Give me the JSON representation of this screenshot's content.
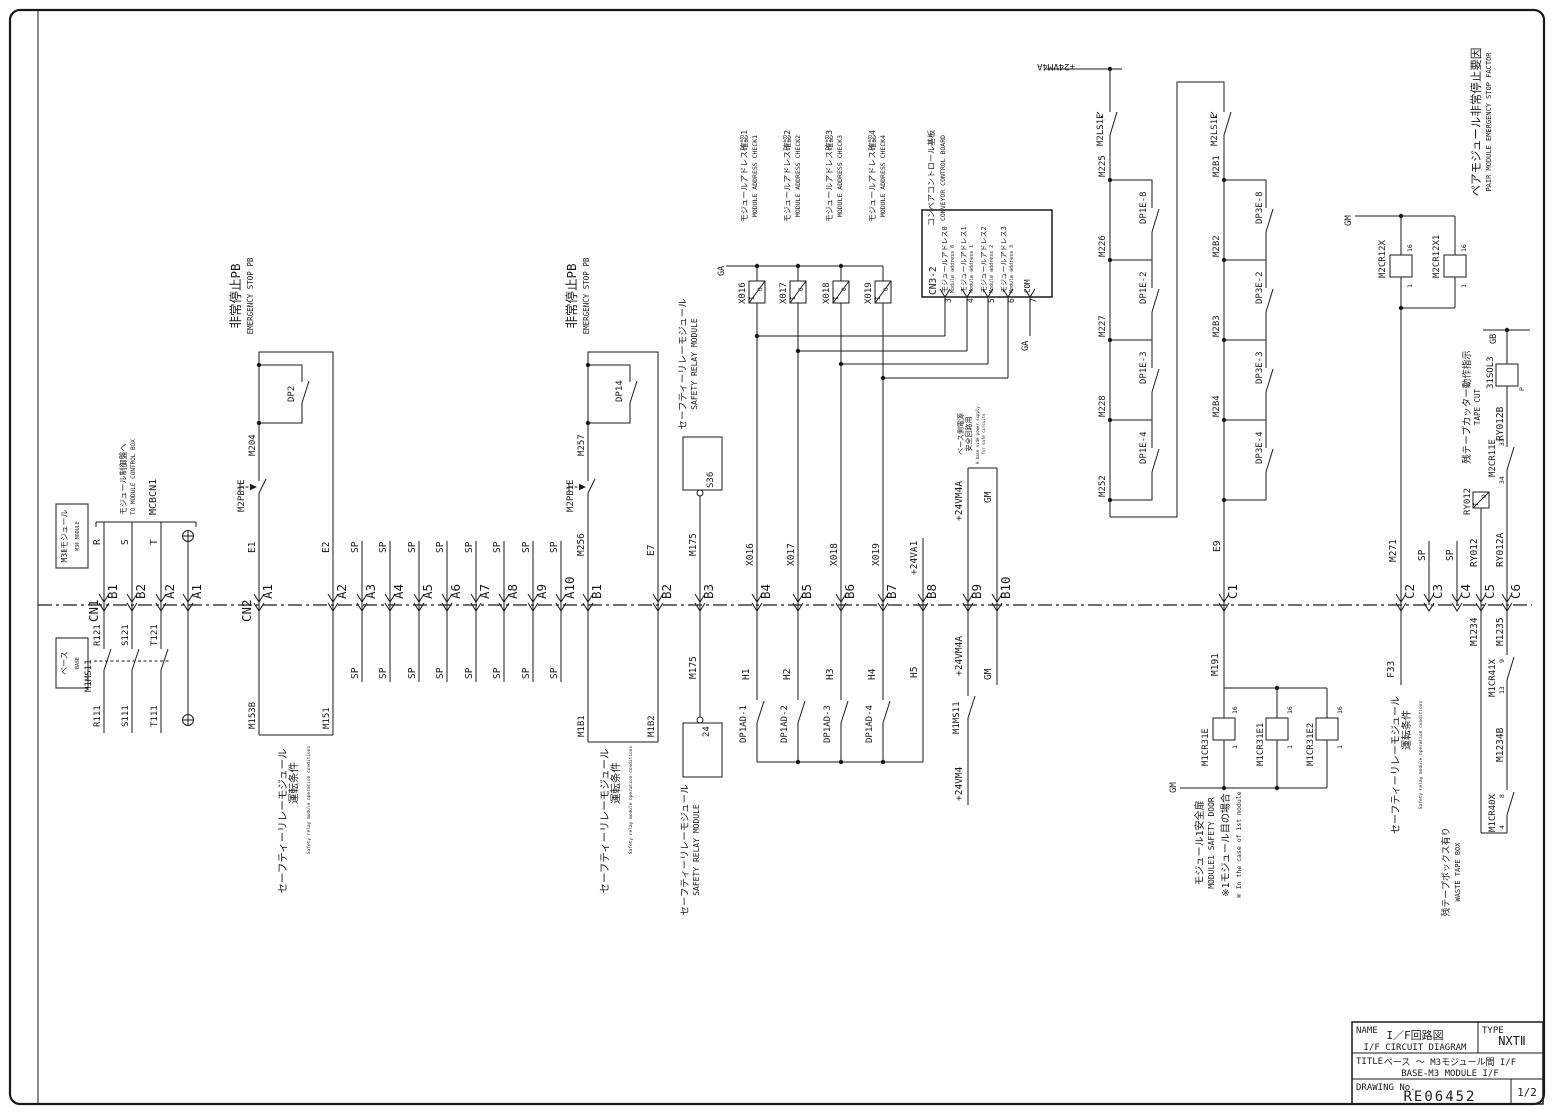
{
  "title_block": {
    "name_label": "NAME",
    "name_jp": "I／F回路図",
    "name_en": "I/F CIRCUIT DIAGRAM",
    "type_label": "TYPE",
    "type_value": "NXTⅡ",
    "title_label": "TITLE",
    "title_jp": "ベース 〜 M3モジュール間 I/F",
    "title_en": "BASE-M3 MODULE I/F",
    "drawing_no_label": "DRAWING No.",
    "drawing_no": "RE06452",
    "page": "1/2"
  },
  "pins": [
    {
      "id": "B1",
      "x": 104
    },
    {
      "id": "B2",
      "x": 132
    },
    {
      "id": "A2",
      "x": 161
    },
    {
      "id": "A1",
      "x": 188
    },
    {
      "id": "A1",
      "x": 259
    },
    {
      "id": "A2",
      "x": 333
    },
    {
      "id": "A3",
      "x": 362
    },
    {
      "id": "A4",
      "x": 390
    },
    {
      "id": "A5",
      "x": 419
    },
    {
      "id": "A6",
      "x": 447
    },
    {
      "id": "A7",
      "x": 476
    },
    {
      "id": "A8",
      "x": 504
    },
    {
      "id": "A9",
      "x": 533
    },
    {
      "id": "A10",
      "x": 561
    },
    {
      "id": "B1",
      "x": 588
    },
    {
      "id": "B2",
      "x": 658
    },
    {
      "id": "B3",
      "x": 700
    },
    {
      "id": "B4",
      "x": 757
    },
    {
      "id": "B5",
      "x": 798
    },
    {
      "id": "B6",
      "x": 841
    },
    {
      "id": "B7",
      "x": 883
    },
    {
      "id": "B8",
      "x": 923
    },
    {
      "id": "B9",
      "x": 968
    },
    {
      "id": "B10",
      "x": 997
    },
    {
      "id": "C1",
      "x": 1224
    },
    {
      "id": "C2",
      "x": 1401
    },
    {
      "id": "C3",
      "x": 1429
    },
    {
      "id": "C4",
      "x": 1457
    },
    {
      "id": "C5",
      "x": 1481
    },
    {
      "id": "C6",
      "x": 1507
    }
  ],
  "labels": [
    {
      "t": "M3Ⅱモジュール",
      "x": 67,
      "y": 536,
      "s": 8,
      "a": "m"
    },
    {
      "t": "M3Ⅱ MODULE",
      "x": 79,
      "y": 536,
      "s": 5,
      "a": "m"
    },
    {
      "t": "ベース",
      "x": 67,
      "y": 663,
      "s": 8,
      "a": "m"
    },
    {
      "t": "BASE",
      "x": 79,
      "y": 663,
      "s": 5,
      "a": "m"
    },
    {
      "t": "CN1",
      "x": 98,
      "y": 622,
      "s": 12.5
    },
    {
      "t": "モジュール制御盤へ",
      "x": 126,
      "y": 515,
      "s": 8
    },
    {
      "t": "TO MODULE CONTROL BOX",
      "x": 135,
      "y": 515,
      "s": 6
    },
    {
      "t": "MCBCN1",
      "x": 156,
      "y": 515,
      "s": 10
    },
    {
      "t": "R",
      "x": 100,
      "y": 545
    },
    {
      "t": "S",
      "x": 128,
      "y": 545
    },
    {
      "t": "T",
      "x": 157,
      "y": 545
    },
    {
      "t": "R121",
      "x": 100,
      "y": 646,
      "s": 9
    },
    {
      "t": "S121",
      "x": 128,
      "y": 646,
      "s": 9
    },
    {
      "t": "T121",
      "x": 157,
      "y": 646,
      "s": 9
    },
    {
      "t": "M1MS11",
      "x": 91,
      "y": 692,
      "s": 9
    },
    {
      "t": "R111",
      "x": 100,
      "y": 727,
      "s": 9
    },
    {
      "t": "S111",
      "x": 128,
      "y": 727,
      "s": 9
    },
    {
      "t": "T111",
      "x": 157,
      "y": 727,
      "s": 9
    },
    {
      "t": "CN2",
      "x": 251,
      "y": 622,
      "s": 12.5
    },
    {
      "t": "E1",
      "x": 255,
      "y": 553
    },
    {
      "t": "M2PB1E",
      "x": 244,
      "y": 512,
      "s": 9
    },
    {
      "t": "M204",
      "x": 255,
      "y": 456,
      "s": 9
    },
    {
      "t": "DP2",
      "x": 294,
      "y": 402,
      "s": 9
    },
    {
      "t": "E2",
      "x": 329,
      "y": 553
    },
    {
      "t": "非常停止PB",
      "x": 240,
      "y": 296,
      "a": "m",
      "s": 12.5
    },
    {
      "t": "EMERGENCY STOP PB",
      "x": 253,
      "y": 296,
      "a": "m",
      "s": 7.5
    },
    {
      "t": "M153B",
      "x": 255,
      "y": 729,
      "s": 9
    },
    {
      "t": "M151",
      "x": 329,
      "y": 729,
      "s": 9
    },
    {
      "t": "セーフティーリレーモジュール",
      "x": 286,
      "y": 821,
      "a": "m",
      "s": 10.5
    },
    {
      "t": "運転条件",
      "x": 297,
      "y": 783,
      "a": "m",
      "s": 10.5
    },
    {
      "t": "Safety relay module operation conditions",
      "x": 310,
      "y": 800,
      "a": "m",
      "s": 4.5
    },
    {
      "t": "SP",
      "x": 358,
      "y": 553
    },
    {
      "t": "SP",
      "x": 386,
      "y": 553
    },
    {
      "t": "SP",
      "x": 415,
      "y": 553
    },
    {
      "t": "SP",
      "x": 443,
      "y": 553
    },
    {
      "t": "SP",
      "x": 472,
      "y": 553
    },
    {
      "t": "SP",
      "x": 500,
      "y": 553
    },
    {
      "t": "SP",
      "x": 529,
      "y": 553
    },
    {
      "t": "SP",
      "x": 557,
      "y": 553
    },
    {
      "t": "SP",
      "x": 358,
      "y": 679
    },
    {
      "t": "SP",
      "x": 386,
      "y": 679
    },
    {
      "t": "SP",
      "x": 415,
      "y": 679
    },
    {
      "t": "SP",
      "x": 443,
      "y": 679
    },
    {
      "t": "SP",
      "x": 472,
      "y": 679
    },
    {
      "t": "SP",
      "x": 500,
      "y": 679
    },
    {
      "t": "SP",
      "x": 529,
      "y": 679
    },
    {
      "t": "SP",
      "x": 557,
      "y": 679
    },
    {
      "t": "M256",
      "x": 584,
      "y": 556
    },
    {
      "t": "M2PB1E",
      "x": 573,
      "y": 512,
      "s": 9
    },
    {
      "t": "M257",
      "x": 584,
      "y": 456,
      "s": 9
    },
    {
      "t": "DP14",
      "x": 622,
      "y": 402,
      "s": 9
    },
    {
      "t": "E7",
      "x": 654,
      "y": 556
    },
    {
      "t": "非常停止PB",
      "x": 576,
      "y": 296,
      "a": "m",
      "s": 12.5
    },
    {
      "t": "EMERGENCY STOP PB",
      "x": 589,
      "y": 296,
      "a": "m",
      "s": 7.5
    },
    {
      "t": "M1B1",
      "x": 584,
      "y": 737,
      "s": 9
    },
    {
      "t": "M1B2",
      "x": 654,
      "y": 737,
      "s": 9
    },
    {
      "t": "セーフティーリレーモジュール",
      "x": 608,
      "y": 821,
      "a": "m",
      "s": 10.5
    },
    {
      "t": "運転条件",
      "x": 619,
      "y": 783,
      "a": "m",
      "s": 10.5
    },
    {
      "t": "Safety relay module operation conditions",
      "x": 632,
      "y": 800,
      "a": "m",
      "s": 4.5
    },
    {
      "t": "M175",
      "x": 696,
      "y": 556
    },
    {
      "t": "S36",
      "x": 713,
      "y": 488,
      "s": 9
    },
    {
      "t": "セーフティーリレーモジュール",
      "x": 686,
      "y": 364,
      "a": "m",
      "s": 9.5
    },
    {
      "t": "SAFETY RELAY MODULE",
      "x": 697,
      "y": 364,
      "a": "m",
      "s": 8
    },
    {
      "t": "M175",
      "x": 696,
      "y": 679
    },
    {
      "t": "24",
      "x": 709,
      "y": 737,
      "s": 9
    },
    {
      "t": "セーフティーリレーモジュール",
      "x": 688,
      "y": 850,
      "a": "m",
      "s": 9.5
    },
    {
      "t": "SAFETY RELAY MODULE",
      "x": 699,
      "y": 850,
      "a": "m",
      "s": 8
    },
    {
      "t": "X016",
      "x": 753,
      "y": 566
    },
    {
      "t": "X017",
      "x": 794,
      "y": 566
    },
    {
      "t": "X018",
      "x": 837,
      "y": 566
    },
    {
      "t": "X019",
      "x": 879,
      "y": 566
    },
    {
      "t": "X016",
      "x": 745,
      "y": 304,
      "s": 9
    },
    {
      "t": "X017",
      "x": 786,
      "y": 304,
      "s": 9
    },
    {
      "t": "X018",
      "x": 829,
      "y": 304,
      "s": 9
    },
    {
      "t": "X019",
      "x": 871,
      "y": 304,
      "s": 9
    },
    {
      "t": "モジュールアドレス確認1",
      "x": 747,
      "y": 176,
      "a": "m",
      "s": 8
    },
    {
      "t": "モジュールアドレス確認2",
      "x": 790,
      "y": 176,
      "a": "m",
      "s": 8
    },
    {
      "t": "モジュールアドレス確認3",
      "x": 832,
      "y": 176,
      "a": "m",
      "s": 8
    },
    {
      "t": "モジュールアドレス確認4",
      "x": 875,
      "y": 176,
      "a": "m",
      "s": 8
    },
    {
      "t": "MODULE ADDRESS CHECK1",
      "x": 757,
      "y": 176,
      "a": "m",
      "s": 6.5
    },
    {
      "t": "MODULE ADDRESS CHECK2",
      "x": 800,
      "y": 176,
      "a": "m",
      "s": 6.5
    },
    {
      "t": "MODULE ADDRESS CHECK3",
      "x": 842,
      "y": 176,
      "a": "m",
      "s": 6.5
    },
    {
      "t": "MODULE ADDRESS CHECK4",
      "x": 885,
      "y": 176,
      "a": "m",
      "s": 6.5
    },
    {
      "t": "GA",
      "x": 724,
      "y": 276,
      "s": 8.5
    },
    {
      "t": "コンベアコントロール基板",
      "x": 934,
      "y": 178,
      "a": "m",
      "s": 8
    },
    {
      "t": "CONVEYOR CONTROL BOARD",
      "x": 945,
      "y": 178,
      "a": "m",
      "s": 6.5
    },
    {
      "t": "CN3-2",
      "x": 936,
      "y": 295,
      "s": 9.5
    },
    {
      "t": "モジュールアドレス0",
      "x": 947,
      "y": 293,
      "s": 7
    },
    {
      "t": "Module address 0",
      "x": 954,
      "y": 293,
      "s": 5
    },
    {
      "t": "モジュールアドレス1",
      "x": 966,
      "y": 293,
      "s": 7
    },
    {
      "t": "Module address 1",
      "x": 973,
      "y": 293,
      "s": 5
    },
    {
      "t": "モジュールアドレス2",
      "x": 986,
      "y": 293,
      "s": 7
    },
    {
      "t": "Module address 2",
      "x": 993,
      "y": 293,
      "s": 5
    },
    {
      "t": "モジュールアドレス3",
      "x": 1006,
      "y": 293,
      "s": 7
    },
    {
      "t": "Module address 3",
      "x": 1013,
      "y": 293,
      "s": 5
    },
    {
      "t": "COM",
      "x": 1030,
      "y": 293,
      "s": 7.5
    },
    {
      "t": "3",
      "x": 951,
      "y": 303,
      "s": 8
    },
    {
      "t": "4",
      "x": 973,
      "y": 303,
      "s": 8
    },
    {
      "t": "5",
      "x": 994,
      "y": 303,
      "s": 8
    },
    {
      "t": "6",
      "x": 1014,
      "y": 303,
      "s": 8
    },
    {
      "t": "7",
      "x": 1036,
      "y": 303,
      "s": 8
    },
    {
      "t": "GA",
      "x": 1028,
      "y": 351,
      "s": 8.5
    },
    {
      "t": "H1",
      "x": 749,
      "y": 680
    },
    {
      "t": "H2",
      "x": 790,
      "y": 680
    },
    {
      "t": "H3",
      "x": 833,
      "y": 680
    },
    {
      "t": "H4",
      "x": 875,
      "y": 680
    },
    {
      "t": "H5",
      "x": 917,
      "y": 678
    },
    {
      "t": "DP1AD-1",
      "x": 746,
      "y": 743,
      "s": 9
    },
    {
      "t": "DP1AD-2",
      "x": 787,
      "y": 743,
      "s": 9
    },
    {
      "t": "DP1AD-3",
      "x": 830,
      "y": 743,
      "s": 9
    },
    {
      "t": "DP1AD-4",
      "x": 872,
      "y": 743,
      "s": 9
    },
    {
      "t": "+24VA1",
      "x": 917,
      "y": 575
    },
    {
      "t": "+24VM4A",
      "x": 962,
      "y": 521
    },
    {
      "t": "GM",
      "x": 991,
      "y": 503
    },
    {
      "t": "ベース側電源",
      "x": 963,
      "y": 434,
      "a": "m",
      "s": 7
    },
    {
      "t": "安全回路用",
      "x": 971,
      "y": 434,
      "a": "m",
      "s": 7
    },
    {
      "t": "A base side power supply.",
      "x": 979,
      "y": 434,
      "a": "m",
      "s": 4
    },
    {
      "t": "for safe circuits",
      "x": 985,
      "y": 434,
      "a": "m",
      "s": 4
    },
    {
      "t": "+24VM4A",
      "x": 962,
      "y": 676
    },
    {
      "t": "M1MS11",
      "x": 959,
      "y": 734,
      "s": 9
    },
    {
      "t": "+24VM4",
      "x": 962,
      "y": 801
    },
    {
      "t": "GM",
      "x": 991,
      "y": 680
    },
    {
      "t": "+24VM4A",
      "x": 1056,
      "y": 64,
      "r": 180,
      "a": "m",
      "s": 9
    },
    {
      "t": "M2LS1E",
      "x": 1103,
      "y": 146,
      "s": 9
    },
    {
      "t": "M2LS1E",
      "x": 1217,
      "y": 146,
      "s": 9
    },
    {
      "t": "M225",
      "x": 1105,
      "y": 177,
      "s": 9
    },
    {
      "t": "M226",
      "x": 1105,
      "y": 257,
      "s": 9
    },
    {
      "t": "M227",
      "x": 1105,
      "y": 337,
      "s": 9
    },
    {
      "t": "M228",
      "x": 1105,
      "y": 417,
      "s": 9
    },
    {
      "t": "M252",
      "x": 1105,
      "y": 497,
      "s": 9
    },
    {
      "t": "DP1E-8",
      "x": 1146,
      "y": 224,
      "s": 9
    },
    {
      "t": "DP1E-2",
      "x": 1146,
      "y": 304,
      "s": 9
    },
    {
      "t": "DP1E-3",
      "x": 1146,
      "y": 384,
      "s": 9
    },
    {
      "t": "DP1E-4",
      "x": 1146,
      "y": 464,
      "s": 9
    },
    {
      "t": "M2B1",
      "x": 1219,
      "y": 177,
      "s": 9
    },
    {
      "t": "M2B2",
      "x": 1219,
      "y": 257,
      "s": 9
    },
    {
      "t": "M2B3",
      "x": 1219,
      "y": 337,
      "s": 9
    },
    {
      "t": "M2B4",
      "x": 1219,
      "y": 417,
      "s": 9
    },
    {
      "t": "DP3E-8",
      "x": 1262,
      "y": 224,
      "s": 9
    },
    {
      "t": "DP3E-2",
      "x": 1262,
      "y": 304,
      "s": 9
    },
    {
      "t": "DP3E-3",
      "x": 1262,
      "y": 384,
      "s": 9
    },
    {
      "t": "DP3E-4",
      "x": 1262,
      "y": 464,
      "s": 9
    },
    {
      "t": "E9",
      "x": 1220,
      "y": 552
    },
    {
      "t": "M191",
      "x": 1218,
      "y": 676
    },
    {
      "t": "GM",
      "x": 1176,
      "y": 793,
      "s": 9
    },
    {
      "t": "M1CR31E",
      "x": 1208,
      "y": 766,
      "s": 9
    },
    {
      "t": "M1CR31E1",
      "x": 1263,
      "y": 766,
      "s": 9
    },
    {
      "t": "M1CR31E2",
      "x": 1313,
      "y": 766,
      "s": 9
    },
    {
      "t": "16",
      "x": 1237,
      "y": 714,
      "s": 6.5
    },
    {
      "t": "1",
      "x": 1237,
      "y": 749,
      "s": 6.5
    },
    {
      "t": "16",
      "x": 1292,
      "y": 714,
      "s": 6.5
    },
    {
      "t": "1",
      "x": 1292,
      "y": 749,
      "s": 6.5
    },
    {
      "t": "16",
      "x": 1342,
      "y": 714,
      "s": 6.5
    },
    {
      "t": "1",
      "x": 1342,
      "y": 749,
      "s": 6.5
    },
    {
      "t": "モジュール1安全扉",
      "x": 1203,
      "y": 843,
      "a": "m",
      "s": 10
    },
    {
      "t": "MODULE1 SAFETY DOOR",
      "x": 1214,
      "y": 843,
      "a": "m",
      "s": 8
    },
    {
      "t": "※1モジュール目の場合",
      "x": 1229,
      "y": 845,
      "a": "m",
      "s": 10
    },
    {
      "t": "※ In the case of 1st module",
      "x": 1241,
      "y": 845,
      "a": "m",
      "s": 6.5
    },
    {
      "t": "ペアモジュール非常停止要因",
      "x": 1480,
      "y": 122,
      "a": "m",
      "s": 11.5
    },
    {
      "t": "PAIR MODULE EMERGENCY STOP FACTOR",
      "x": 1491,
      "y": 122,
      "a": "m",
      "s": 7
    },
    {
      "t": "GM",
      "x": 1351,
      "y": 226,
      "s": 9
    },
    {
      "t": "M2CR12X",
      "x": 1385,
      "y": 278,
      "s": 9
    },
    {
      "t": "M2CR12X1",
      "x": 1439,
      "y": 278,
      "s": 9
    },
    {
      "t": "16",
      "x": 1412,
      "y": 252,
      "s": 6.5
    },
    {
      "t": "1",
      "x": 1412,
      "y": 288,
      "s": 6.5
    },
    {
      "t": "16",
      "x": 1466,
      "y": 252,
      "s": 6.5
    },
    {
      "t": "1",
      "x": 1466,
      "y": 288,
      "s": 6.5
    },
    {
      "t": "M271",
      "x": 1396,
      "y": 562
    },
    {
      "t": "F33",
      "x": 1394,
      "y": 678
    },
    {
      "t": "セーフティーリレーモジュール",
      "x": 1399,
      "y": 765,
      "a": "m",
      "s": 10
    },
    {
      "t": "運転条件",
      "x": 1410,
      "y": 730,
      "a": "m",
      "s": 10
    },
    {
      "t": "Safety relay module operation conditions",
      "x": 1422,
      "y": 755,
      "a": "m",
      "s": 4.5
    },
    {
      "t": "SP",
      "x": 1425,
      "y": 561
    },
    {
      "t": "SP",
      "x": 1453,
      "y": 561
    },
    {
      "t": "GB",
      "x": 1496,
      "y": 344,
      "s": 8.5
    },
    {
      "t": "31SOL3",
      "x": 1493,
      "y": 389,
      "s": 9
    },
    {
      "t": "P",
      "x": 1524,
      "y": 391,
      "s": 6.5
    },
    {
      "t": "RY012B",
      "x": 1503,
      "y": 441
    },
    {
      "t": "M2CR11E",
      "x": 1495,
      "y": 477,
      "s": 9
    },
    {
      "t": "34",
      "x": 1504,
      "y": 484,
      "s": 6.5
    },
    {
      "t": "33",
      "x": 1504,
      "y": 446,
      "s": 6.5
    },
    {
      "t": "残テープカッター動作指示",
      "x": 1470,
      "y": 407,
      "a": "m",
      "s": 9.5
    },
    {
      "t": "TAPE CUT",
      "x": 1480,
      "y": 407,
      "a": "m",
      "s": 7.5
    },
    {
      "t": "RY012",
      "x": 1470,
      "y": 515,
      "s": 9
    },
    {
      "t": "RY012",
      "x": 1477,
      "y": 567
    },
    {
      "t": "RY012A",
      "x": 1503,
      "y": 567
    },
    {
      "t": "M1234",
      "x": 1477,
      "y": 646
    },
    {
      "t": "M1235",
      "x": 1503,
      "y": 646
    },
    {
      "t": "M1CR41X",
      "x": 1495,
      "y": 697,
      "s": 9
    },
    {
      "t": "13",
      "x": 1504,
      "y": 694,
      "s": 6.5
    },
    {
      "t": "9",
      "x": 1504,
      "y": 663,
      "s": 6.5
    },
    {
      "t": "M1234B",
      "x": 1503,
      "y": 762
    },
    {
      "t": "M1CR40X",
      "x": 1495,
      "y": 832,
      "s": 9
    },
    {
      "t": "4",
      "x": 1504,
      "y": 829,
      "s": 6.5
    },
    {
      "t": "8",
      "x": 1504,
      "y": 798,
      "s": 6.5
    },
    {
      "t": "残テープボックス有り",
      "x": 1449,
      "y": 872,
      "a": "m",
      "s": 9
    },
    {
      "t": "WASTE TAPE BOX",
      "x": 1460,
      "y": 872,
      "a": "m",
      "s": 7
    },
    {
      "t": "I",
      "x": 754,
      "y": 300,
      "s": 6
    },
    {
      "t": "O",
      "x": 762,
      "y": 291,
      "s": 6
    },
    {
      "t": "I",
      "x": 795,
      "y": 300,
      "s": 6
    },
    {
      "t": "O",
      "x": 803,
      "y": 291,
      "s": 6
    },
    {
      "t": "I",
      "x": 838,
      "y": 300,
      "s": 6
    },
    {
      "t": "O",
      "x": 846,
      "y": 291,
      "s": 6
    },
    {
      "t": "I",
      "x": 880,
      "y": 300,
      "s": 6
    },
    {
      "t": "O",
      "x": 888,
      "y": 291,
      "s": 6
    },
    {
      "t": "I",
      "x": 1478,
      "y": 506,
      "s": 6
    },
    {
      "t": "O",
      "x": 1486,
      "y": 498,
      "s": 6
    }
  ]
}
